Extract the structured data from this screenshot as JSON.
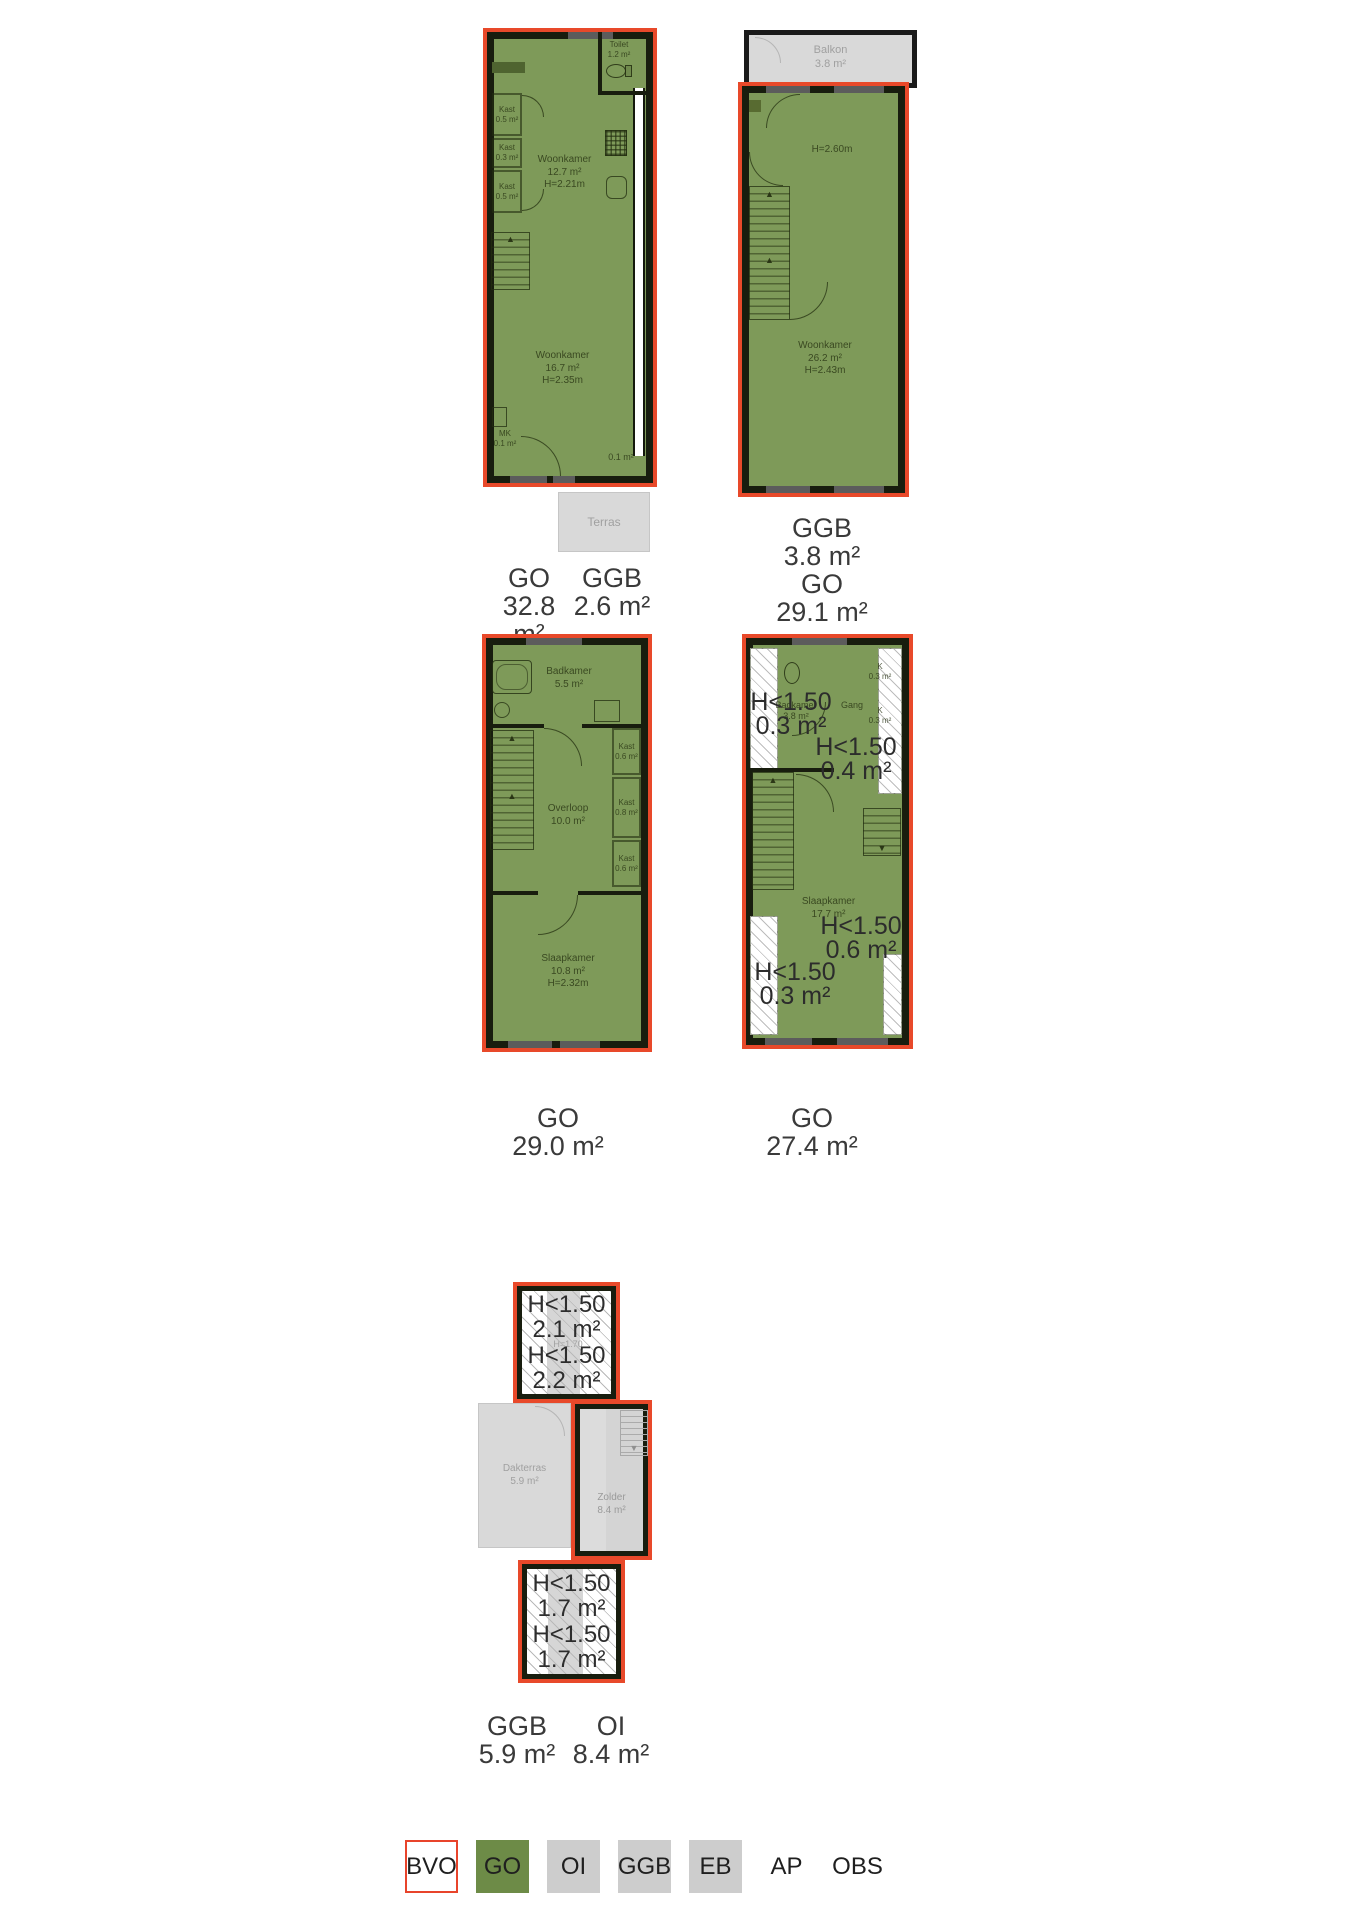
{
  "plans": {
    "floor_top_left": {
      "toilet_name": "Toilet",
      "toilet_area": "1.2 m²",
      "kast1_name": "Kast",
      "kast1_area": "0.5 m²",
      "kast2_name": "Kast",
      "kast2_area": "0.3 m²",
      "kast3_name": "Kast",
      "kast3_area": "0.5 m²",
      "woonkamer1_name": "Woonkamer",
      "woonkamer1_area": "12.7 m²",
      "woonkamer1_height": "H=2.21m",
      "woonkamer2_name": "Woonkamer",
      "woonkamer2_area": "16.7 m²",
      "woonkamer2_height": "H=2.35m",
      "mk_name": "MK",
      "mk_area": "0.1 m²",
      "niche_area": "0.1 m²",
      "terras_name": "Terras",
      "measures": [
        {
          "code": "GO",
          "value": "32.8 m²"
        },
        {
          "code": "GGB",
          "value": "2.6 m²"
        }
      ]
    },
    "floor_top_right": {
      "balkon_name": "Balkon",
      "balkon_area": "3.8 m²",
      "height_note": "H=2.60m",
      "woonkamer_name": "Woonkamer",
      "woonkamer_area": "26.2 m²",
      "woonkamer_height": "H=2.43m",
      "measures": [
        {
          "code": "GGB",
          "value": "3.8 m²"
        },
        {
          "code": "GO",
          "value": "29.1 m²"
        }
      ]
    },
    "floor_mid_left": {
      "badkamer_name": "Badkamer",
      "badkamer_area": "5.5 m²",
      "kast1_name": "Kast",
      "kast1_area": "0.6 m²",
      "kast2_name": "Kast",
      "kast2_area": "0.8 m²",
      "kast3_name": "Kast",
      "kast3_area": "0.6 m²",
      "overloop_name": "Overloop",
      "overloop_area": "10.0 m²",
      "slaapkamer_name": "Slaapkamer",
      "slaapkamer_area": "10.8 m²",
      "slaapkamer_height": "H=2.32m",
      "measures": [
        {
          "code": "GO",
          "value": "29.0 m²"
        }
      ]
    },
    "floor_mid_right": {
      "badkamer_name": "Badkamer",
      "badkamer_area": "3.8 m²",
      "gang_name": "Gang",
      "k1_name": "K",
      "k1_area": "0.3 m²",
      "k2_name": "K",
      "k2_area": "0.3 m²",
      "slaapkamer_name": "Slaapkamer",
      "slaapkamer_area": "17.7 m²",
      "zones": [
        {
          "label": "H<1.50",
          "area": "0.3 m²"
        },
        {
          "label": "H<1.50",
          "area": "0.4 m²"
        },
        {
          "label": "H<1.50",
          "area": "0.6 m²"
        },
        {
          "label": "H<1.50",
          "area": "0.3 m²"
        }
      ],
      "measures": [
        {
          "code": "GO",
          "value": "27.4 m²"
        }
      ]
    },
    "floor_attic": {
      "zones": [
        {
          "label": "H<1.50",
          "area": "2.1 m²"
        },
        {
          "label": "H<1.50",
          "area": "2.2 m²"
        },
        {
          "label": "H<1.50",
          "area": "1.7 m²"
        },
        {
          "label": "H<1.50",
          "area": "1.7 m²"
        }
      ],
      "height_note": "H=1.70",
      "dakterras_name": "Dakterras",
      "dakterras_area": "5.9 m²",
      "zolder_name": "Zolder",
      "zolder_area": "8.4 m²",
      "measures": [
        {
          "code": "GGB",
          "value": "5.9 m²"
        },
        {
          "code": "OI",
          "value": "8.4 m²"
        }
      ]
    }
  },
  "legend": {
    "items": [
      {
        "code": "BVO"
      },
      {
        "code": "GO"
      },
      {
        "code": "OI"
      },
      {
        "code": "GGB"
      },
      {
        "code": "EB"
      },
      {
        "code": "AP"
      },
      {
        "code": "OBS"
      }
    ]
  },
  "colors": {
    "outline_red": "#e8492a",
    "go_green": "#6d8b47",
    "category_gray": "#cdcdcd"
  }
}
